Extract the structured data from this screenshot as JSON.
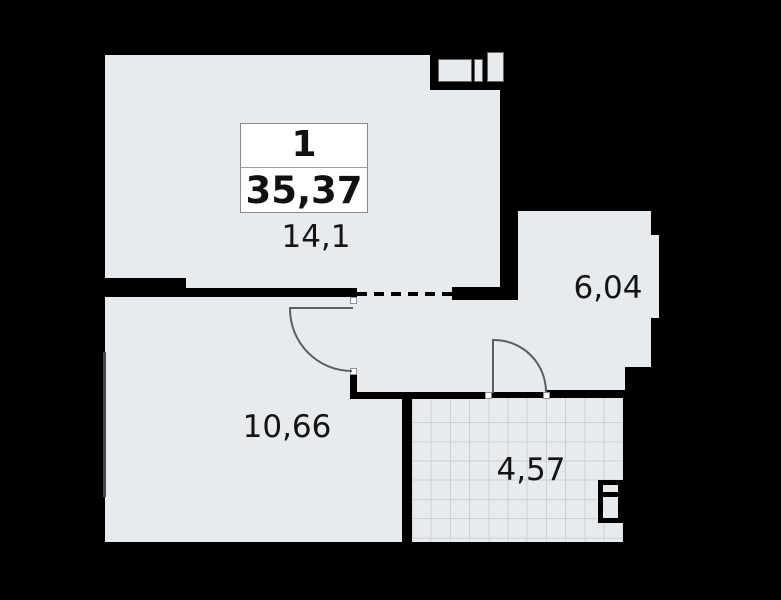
{
  "floor_plan": {
    "unit_card": {
      "rooms_count": "1",
      "total_area": "35,37"
    },
    "rooms": [
      {
        "name": "living-room",
        "area": "14,1"
      },
      {
        "name": "bedroom",
        "area": "10,66"
      },
      {
        "name": "hallway",
        "area": "6,04"
      },
      {
        "name": "bathroom",
        "area": "4,57"
      }
    ],
    "colors": {
      "background": "#000000",
      "wall": "#000000",
      "floor": "#e8ebee",
      "tile_line": "#ccd1d6",
      "card_background": "#ffffff",
      "card_border": "#8a8a8a",
      "text": "#141414"
    }
  }
}
